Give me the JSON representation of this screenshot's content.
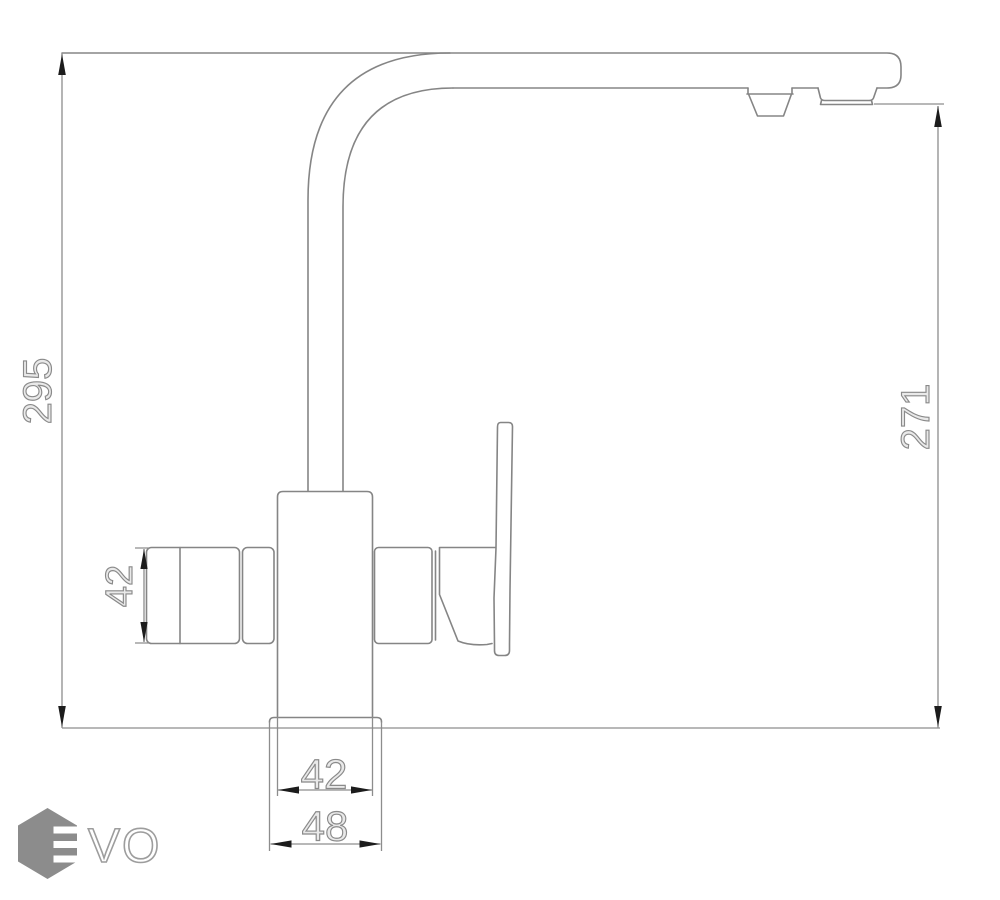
{
  "drawing": {
    "title": "faucet-dimension-drawing",
    "dimensions": {
      "total_height": "295",
      "outlet_height": "271",
      "valve_height": "42",
      "body_width": "42",
      "base_width": "48"
    },
    "units": "mm"
  },
  "logo": {
    "text": "VO",
    "mark": "hexagon-e-icon",
    "color": "#8c8c8c"
  },
  "colors": {
    "background": "#ffffff",
    "line": "#858585",
    "dimension_line": "#8d8d8d",
    "arrow": "#1c1c1c",
    "dim_text_outline": "#8a8a8a"
  }
}
